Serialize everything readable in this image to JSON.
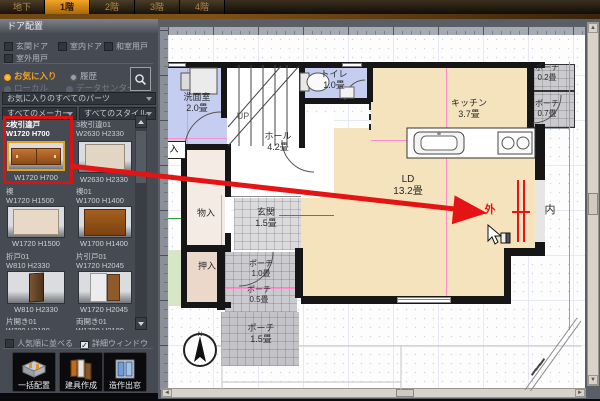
{
  "tabs": {
    "floors": [
      {
        "label": "地下",
        "selected": false
      },
      {
        "label": "1階",
        "selected": true
      },
      {
        "label": "2階",
        "selected": false
      },
      {
        "label": "3階",
        "selected": false
      },
      {
        "label": "4階",
        "selected": false
      }
    ]
  },
  "sidebar": {
    "title": "ドア配置",
    "door_filters": [
      {
        "label": "玄関ドア",
        "checked": false
      },
      {
        "label": "室内ドア",
        "checked": false
      },
      {
        "label": "和室用戸",
        "checked": false
      },
      {
        "label": "室外用戸",
        "checked": false
      }
    ],
    "sources": {
      "favorites": "お気に入り",
      "history": "履歴",
      "local": "ローカル",
      "datacenter": "データセンター"
    },
    "filters": {
      "parts": "お気に入りのすべてのパーツ",
      "maker": "すべてのメーカー",
      "style": "すべてのスタイル"
    },
    "parts": [
      {
        "name": "2枚引違戸",
        "size": "W1720 H700",
        "selected": true
      },
      {
        "name": "3枚引違01",
        "size": "W2630 H2330",
        "selected": false
      },
      {
        "name": "襖",
        "size": "W1720 H1500",
        "selected": false
      },
      {
        "name": "襖01",
        "size": "W1700 H1400",
        "selected": false
      },
      {
        "name": "折戸01",
        "size": "W810 H2330",
        "selected": false
      },
      {
        "name": "片引戸01",
        "size": "W1720 H2045",
        "selected": false
      },
      {
        "name": "片開き01",
        "size": "W780 H2180",
        "selected": false
      },
      {
        "name": "両開き01",
        "size": "W1700 H2180",
        "selected": false
      }
    ],
    "options": [
      {
        "label": "人気順に並べる",
        "checked": false
      },
      {
        "label": "詳細ウィンドウ",
        "checked": true
      }
    ],
    "actions": [
      {
        "label": "一括配置"
      },
      {
        "label": "建具作成"
      },
      {
        "label": "造作出窓"
      }
    ]
  },
  "canvas": {
    "rooms": {
      "washroom": {
        "name": "洗面室",
        "size": "2.0畳"
      },
      "toilet": {
        "name": "トイレ",
        "size": "1.0畳"
      },
      "kitchen": {
        "name": "キッチン",
        "size": "3.7畳"
      },
      "hall": {
        "name": "ホール",
        "size": "4.2畳"
      },
      "ld": {
        "name": "LD",
        "size": "13.2畳"
      },
      "genkan": {
        "name": "玄関",
        "size": "1.5畳"
      },
      "monoire": {
        "name": "物入"
      },
      "oshiire": {
        "name": "押入"
      },
      "porch02": {
        "name": "ポーチ",
        "size": "0.2畳"
      },
      "porch07": {
        "name": "ポーチ",
        "size": "0.7畳"
      },
      "porch10": {
        "name": "ポーチ",
        "size": "1.0畳"
      },
      "porch05": {
        "name": "ポーチ",
        "size": "0.5畳"
      },
      "porch15": {
        "name": "ポーチ",
        "size": "1.5畳"
      },
      "partial": {
        "name": "入"
      }
    },
    "stairs_label": "UP",
    "placement": {
      "outside": "外",
      "inside": "内"
    },
    "compass_label": "N"
  },
  "colors": {
    "tab_selected": "#f2a527",
    "favorite_accent": "#f0a125",
    "selection_red": "#dd1111",
    "arrow_red": "#e41414",
    "room_blue": "#c5cdf0",
    "room_beige": "#f5e3be"
  }
}
